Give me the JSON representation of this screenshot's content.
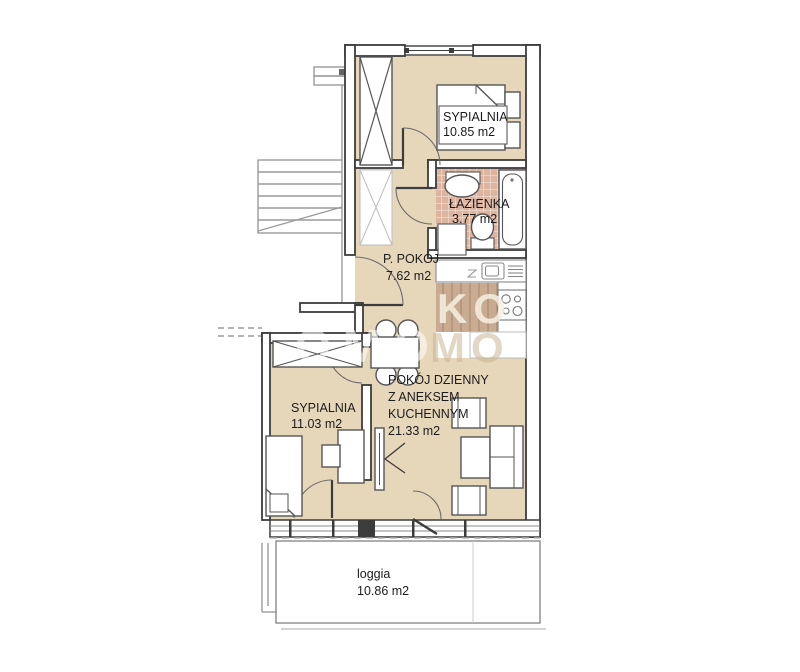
{
  "watermark": {
    "line1": "KO",
    "line2": "MO",
    "echo": "OMO"
  },
  "rooms": {
    "bedroom1": {
      "name": "SYPIALNIA",
      "area": "10.85 m2"
    },
    "bathroom": {
      "name": "ŁAZIENKA",
      "area": "3.77 m2"
    },
    "hall": {
      "name": "P. POKÓJ",
      "area": "7.62 m2"
    },
    "bedroom2": {
      "name": "SYPIALNIA",
      "area": "11.03 m2"
    },
    "living": {
      "line1": "POKÓJ DZIENNY",
      "line2": "Z ANEKSEM",
      "line3": "KUCHENNYM",
      "area": "21.33 m2"
    },
    "loggia": {
      "name": "loggia",
      "area": "10.86 m2"
    }
  },
  "colors": {
    "floor": "#e7d7ba",
    "tile": "#dcb49f",
    "wood": "#c9ab92",
    "wall": "#3c3c3c"
  }
}
